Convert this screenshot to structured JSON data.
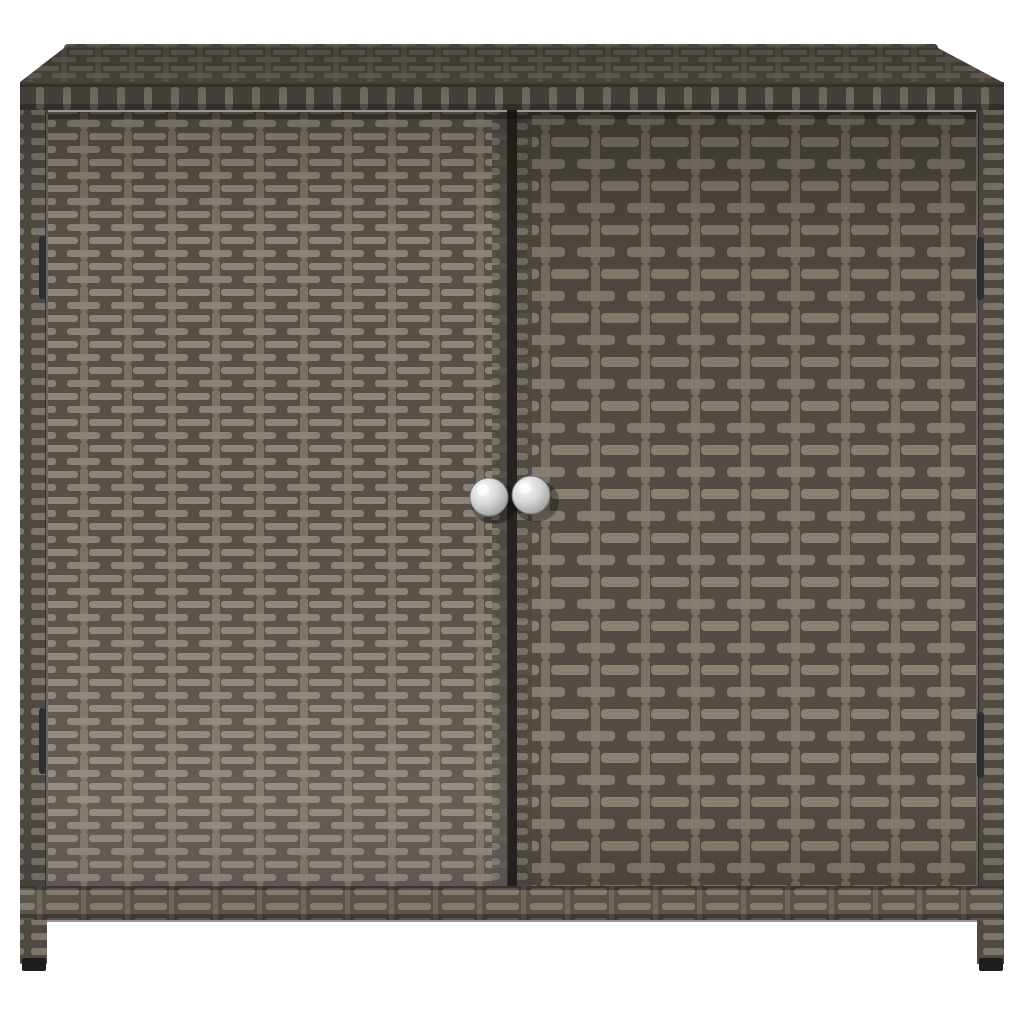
{
  "scene": {
    "description": "Product photo of a grey poly rattan outdoor storage cabinet with two front doors, two round silver knobs, four dark hinges, woven lid and two front legs with black feet, on a plain white background"
  },
  "colors": {
    "background": "#ffffff",
    "door_left_bg": "#575048",
    "door_left_slat": "#8e8578",
    "door_right_bg": "#534c44",
    "door_right_slat": "#897f72",
    "post": "#7b7265",
    "top_bg": "#47423c",
    "top_slat": "#625c52",
    "fascia_bg": "#554e46",
    "fascia_post": "#8a8174",
    "side_bg": "#4f4942",
    "side_slat": "#7d7568",
    "rail_bg": "#5b544b",
    "rail_slat": "#847c6f",
    "seam": "#262220",
    "hinge": "#2e2e32",
    "foot": "#1d1d20",
    "knob_hi": "#fcfcfc",
    "knob_mid": "#d8d8d8",
    "knob_dark": "#8f8f8f",
    "knob_rim": "#777777"
  }
}
